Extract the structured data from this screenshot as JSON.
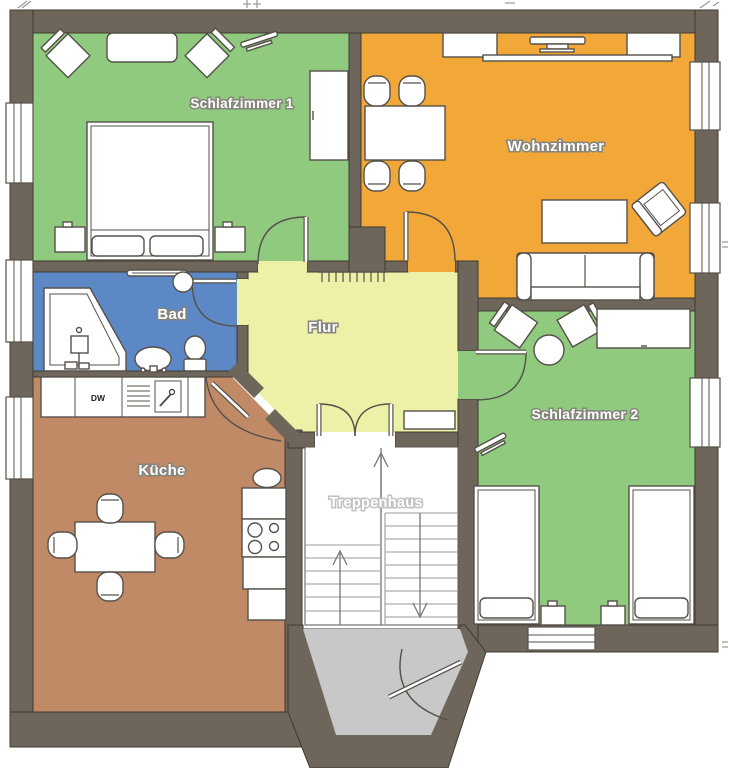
{
  "plan": {
    "title": "apartment-floor-plan",
    "rooms": [
      {
        "id": "schlafzimmer-1",
        "label": "Schlafzimmer 1",
        "color": "#8fca7e"
      },
      {
        "id": "wohnzimmer",
        "label": "Wohnzimmer",
        "color": "#f2a839"
      },
      {
        "id": "bad",
        "label": "Bad",
        "color": "#5d88c6"
      },
      {
        "id": "flur",
        "label": "Flur",
        "color": "#edf0a7"
      },
      {
        "id": "kueche",
        "label": "Küche",
        "color": "#c18a66"
      },
      {
        "id": "schlafzimmer-2",
        "label": "Schlafzimmer 2",
        "color": "#8fca7e"
      },
      {
        "id": "treppenhaus",
        "label": "Treppenhaus",
        "color": "#ffffff"
      }
    ],
    "kitchen": {
      "dishwasher_label": "DW"
    },
    "colors": {
      "wall": "#6e665b",
      "wall_outline": "#3f3a31",
      "furniture_stroke": "#55514a",
      "stair_line": "#9a9a9a",
      "entrance_floor": "#c8c8c8",
      "background": "#ffffff"
    }
  }
}
